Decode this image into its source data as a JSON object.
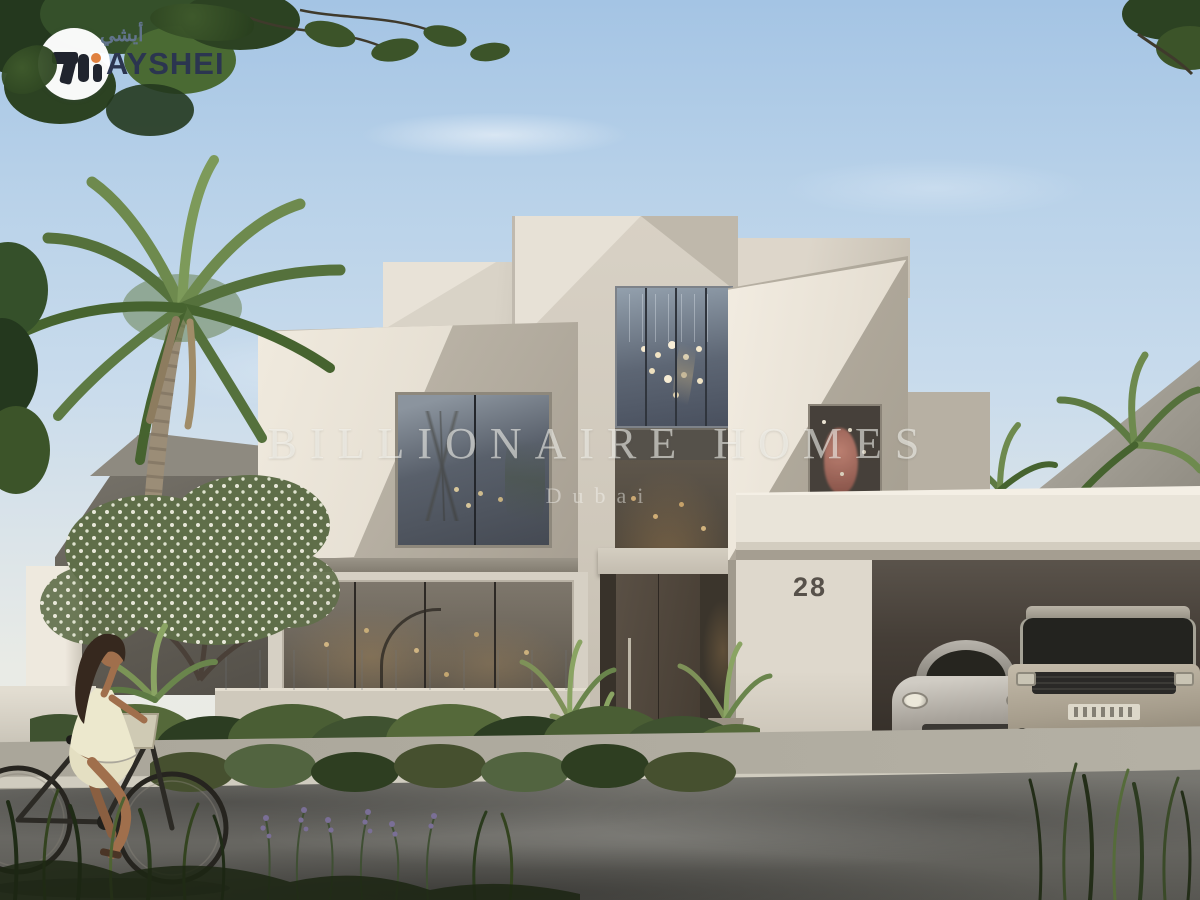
{
  "logo": {
    "brand": "AYSHEI",
    "brand_arabic": "أيشي"
  },
  "watermark": {
    "line1": "BILLIONAIRE HOMES",
    "line2": "Dubai"
  },
  "property": {
    "house_number": "28"
  },
  "scene": {
    "description": "Photorealistic render of a modern geometric two-storey villa in Dubai with a double garage housing a silver sports car and a champagne SUV, palm trees, white-flowering tree, garden hedge, and a woman cycling past on the street",
    "objects": [
      "villa",
      "large-palm-tree",
      "frangipani-tree",
      "garden-hedge",
      "garage-canopy",
      "sports-car",
      "luxury-suv",
      "woman-on-bicycle",
      "street",
      "sidewalk",
      "neighbour-villas"
    ]
  },
  "colors": {
    "sky_top": "#a4c4e4",
    "sky_mid": "#c8dbec",
    "sky_horizon": "#e9ebe6",
    "villa_light": "#e7e1d6",
    "villa_base": "#d8d1c5",
    "villa_mid": "#bfb8ab",
    "villa_shadow": "#a59e90",
    "canopy": "#e9e4d9",
    "wall": "#ded8cc",
    "number": "#57514a",
    "door": "#5a5045",
    "road": "#6e6d68",
    "sidewalk": "#aaa69a",
    "curb": "#d0ccbf",
    "driveway": "#bcb7ab",
    "car_silver": "#a9a49c",
    "car_gold": "#a79e8d",
    "hedge_mid": "#3f5230",
    "palm_green": "#6e8a4e",
    "logo_navy": "#2b3550",
    "logo_orange": "#e0813f",
    "watermark_white": "#f7f6f2"
  }
}
